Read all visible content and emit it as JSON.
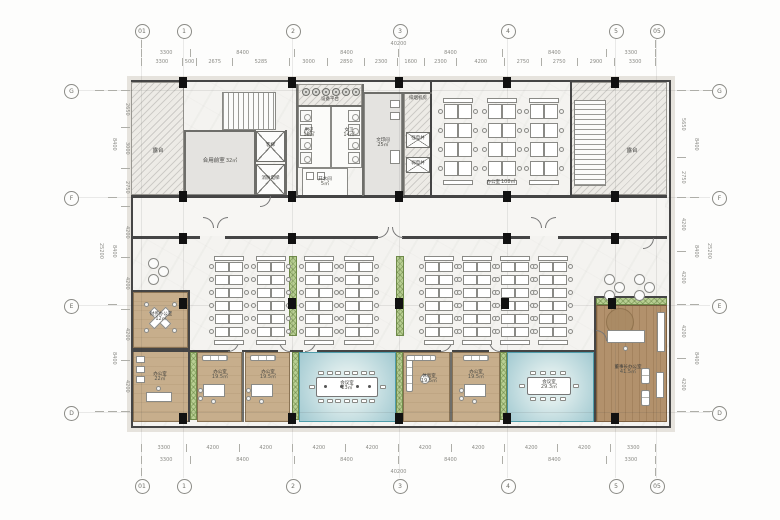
{
  "grid": {
    "top": [
      "01",
      "1",
      "2",
      "3",
      "4",
      "5",
      "05"
    ],
    "bottom": [
      "01",
      "1",
      "2",
      "3",
      "4",
      "5",
      "05"
    ],
    "left": [
      "G",
      "F",
      "E",
      "D"
    ],
    "right": [
      "G",
      "F",
      "E",
      "D"
    ]
  },
  "dimensions": {
    "top_total": [
      "40200"
    ],
    "top_spans": [
      "3300",
      "8400",
      "8400",
      "8400",
      "8400",
      "3300"
    ],
    "top_sub": [
      "3300",
      "500",
      "2675",
      "5285",
      "3000",
      "2850",
      "2300",
      "1600",
      "2300",
      "4200",
      "2750",
      "2750",
      "2900",
      "3300"
    ],
    "bottom_sub": [
      "3300",
      "4200",
      "4200",
      "4200",
      "4200",
      "4200",
      "4200",
      "4200",
      "4200",
      "3300"
    ],
    "bottom_spans": [
      "3300",
      "8400",
      "8400",
      "8400",
      "8400",
      "3300"
    ],
    "bottom_total": [
      "40200"
    ],
    "left_sub": [
      "2650",
      "3000",
      "2750",
      "4200",
      "4200",
      "4200",
      "4200"
    ],
    "left_spans": [
      "8400",
      "8400",
      "8400"
    ],
    "left_total": [
      "25200"
    ],
    "right_sub": [
      "5650",
      "2750",
      "4200",
      "4200",
      "4200",
      "4200"
    ],
    "right_spans": [
      "8400",
      "8400",
      "8400"
    ],
    "right_total": [
      "25200"
    ]
  },
  "rooms": {
    "terrace_left": {
      "name": "露台"
    },
    "terrace_right": {
      "name": "露台"
    },
    "lobby": {
      "name": "合用前室",
      "area": "32㎡"
    },
    "elevator": {
      "name": "客梯"
    },
    "fire_elevator": {
      "name": "消防电梯"
    },
    "mens_wc": {
      "name": "男卫",
      "area": "16㎡"
    },
    "womens_wc": {
      "name": "女卫",
      "area": "14㎡"
    },
    "hot_water": {
      "name": "开水间",
      "area": "5㎡"
    },
    "print_room": {
      "name": "文印间",
      "area": "25㎡"
    },
    "equipment_platform": {
      "name": "设备平台"
    },
    "smoke_fan_room": {
      "name": "排烟机房"
    },
    "strong_elec_shaft": {
      "name": "强电井"
    },
    "weak_elec_shaft": {
      "name": "弱电井"
    },
    "office_108": {
      "name": "办公室",
      "area": "108㎡"
    },
    "finance_office": {
      "name": "财务办公室",
      "area": "12㎡"
    },
    "office_22": {
      "name": "办公室",
      "area": "22㎡"
    },
    "office_a": {
      "name": "办公室",
      "area": "19.5㎡"
    },
    "office_b": {
      "name": "办公室",
      "area": "19.5㎡"
    },
    "office_c": {
      "name": "办公室",
      "area": "19.5㎡"
    },
    "meeting_1": {
      "name": "会议室",
      "area": "23㎡"
    },
    "lounge": {
      "name": "休息室",
      "area": "19.5㎡"
    },
    "meeting_2": {
      "name": "会议室",
      "area": "29.3㎡"
    },
    "chairman_office": {
      "name": "董事长办公室",
      "area": "41.5㎡"
    }
  },
  "colors": {
    "teal_floor": "#a6ccd3",
    "tan_floor": "#c7ae8c",
    "wood_floor": "#b2916c",
    "planter_green": "#b8cf92",
    "wall": "#454545"
  }
}
